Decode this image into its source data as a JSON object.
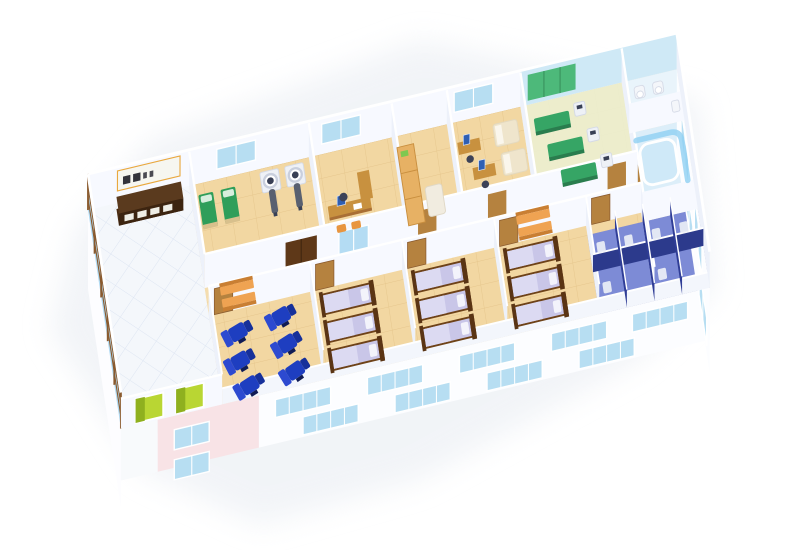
{
  "canvas": {
    "width": 800,
    "height": 550,
    "background": "#ffffff"
  },
  "scene": {
    "type": "3d-isometric-cutaway-floor-plan",
    "subject": "hospital ward floor rendering, viewed from above at an angle on a white background",
    "rooms": [
      {
        "name": "entrance-lobby",
        "features": [
          "glass curtain wall with brown mullions",
          "reception desk with wall sign",
          "two green elevator shafts",
          "white diagonal tile floor"
        ]
      },
      {
        "name": "exam-room",
        "furniture": {
          "green-exam-beds": 2,
          "white-scanners": 2
        },
        "door": "dark wood double door"
      },
      {
        "name": "consultation-office",
        "furniture": {
          "desk": 1,
          "monitor": 1,
          "guest-chairs": 2,
          "office-chair": 1
        }
      },
      {
        "name": "storage-room",
        "furniture": {
          "tan-cabinet": 1,
          "white-couch": 1
        }
      },
      {
        "name": "staff-office",
        "furniture": {
          "desks-with-monitors": 2,
          "beige-daybeds": 2
        }
      },
      {
        "name": "physiotherapy-room",
        "furniture": {
          "green-treatment-tables": 3,
          "white-therapy-machines": 3,
          "green-wall-mats": 1
        },
        "wall": "pale blue rear wall"
      },
      {
        "name": "washroom",
        "furniture": {
          "toilets": 2,
          "sink": 1
        }
      },
      {
        "name": "hydrotherapy-room",
        "features": [
          "curved light-blue glass screen",
          "tub"
        ]
      },
      {
        "name": "corridor",
        "furniture": {
          "orange-benches": 4
        },
        "doors": "tan wood doors to each room"
      },
      {
        "name": "infusion-room",
        "furniture": {
          "blue-recliner-chairs": 6
        },
        "features": [
          "rounded outer corner"
        ]
      },
      {
        "name": "patient-ward-1",
        "furniture": {
          "beds-lavender-bedding": 3
        }
      },
      {
        "name": "patient-ward-2",
        "furniture": {
          "beds-lavender-bedding": 3
        }
      },
      {
        "name": "patient-ward-3",
        "furniture": {
          "beds-lavender-bedding": 3
        }
      },
      {
        "name": "toilet-stalls",
        "features": [
          "dark blue partitions",
          "blue floor",
          "white fixtures"
        ]
      }
    ],
    "exterior": [
      "white facade with staggered pale-blue multi-pane windows",
      "pink wall section with two stacked windows",
      "windowed right end wall",
      "soft ground shadow"
    ],
    "reception_sign": {
      "text_legible": false,
      "style": "dark lettering on white board with orange trim"
    }
  },
  "palette": {
    "bg": "#ffffff",
    "shadow": "#e9edf3",
    "tile": "#f2d7a2",
    "lobbyFloor": "#f4f7fb",
    "wallFace": "#f7f9ff",
    "wallSide": "#edf1fa",
    "glass": "#a9d7f2",
    "frame": "#8a5a2e",
    "window": "#b7def2",
    "doorWood": "#b5823f",
    "doorDark": "#5e3818",
    "greenBed": "#2f9e5a",
    "bedBase": "#d8c08c",
    "benchOrange": "#efa352",
    "benchSide": "#c97f33",
    "reclinerBlue": "#1e3ec0",
    "reclinerBack": "#2d4ad0",
    "reclinerDark": "#16309a",
    "bedPurple": "#c9c6e8",
    "bedPurpleLight": "#dcdaf2",
    "bedFrame": "#6e4218",
    "pillow": "#f3f3fb",
    "deskTop": "#c8913f",
    "deskWood": "#a96f35",
    "deskDark": "#3c2410",
    "deskBase": "#4a2c14",
    "monitorBlue": "#2f5fb3",
    "sofa": "#efe5cc",
    "cabinet": "#e7b164",
    "therapyGreen": "#36a565",
    "therapyFloor": "#ecf0d0",
    "matGreen": "#4db97a",
    "therapyWall": "#cfe9f6",
    "machineWhite": "#eef1f6",
    "machineLine": "#d5dae6",
    "scannerTable": "#596070",
    "elevGreen": "#b9d633",
    "elevDark": "#8fb01f",
    "pinkWall": "#f8e3e6",
    "facade": "#fcfdff",
    "stallFloor": "#7d8bd6",
    "stallDark": "#2c3a8c",
    "stallMid": "#2f3d96",
    "hydroGlass": "#8fd0f2",
    "hydroFloor": "#dceef9",
    "bathFloor": "#e9f4fb",
    "signBoard": "#f6f6f0",
    "signTrim": "#e9a83e",
    "signText": "#33333a",
    "chairDark": "#3c4258",
    "chairOrange": "#e8953f"
  }
}
